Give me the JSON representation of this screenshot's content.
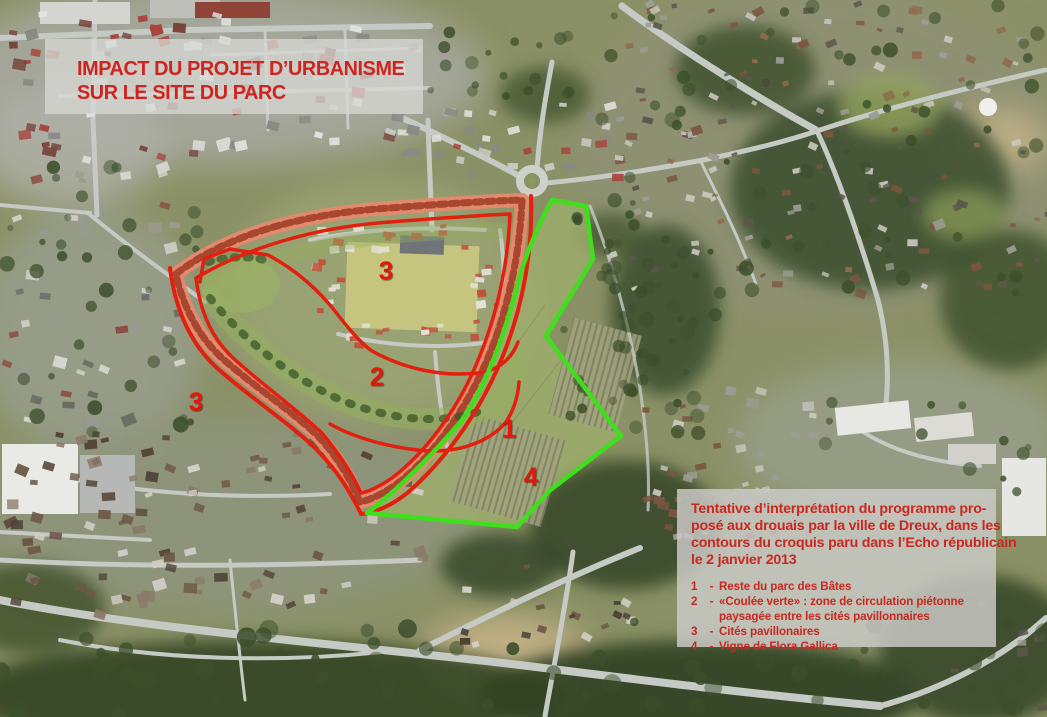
{
  "title_box": {
    "line1": "IMPACT DU PROJET D’URBANISME",
    "line2": "SUR LE SITE DU PARC"
  },
  "legend_box": {
    "paragraph_lines": [
      "Tentative d’interprétation du programme pro-",
      "posé aux drouais par la ville de Dreux, dans les",
      "contours du croquis paru dans l’Echo républicain",
      "le 2 janvier 2013"
    ],
    "items": [
      {
        "num": "1",
        "label": "Reste du parc des Bâtes"
      },
      {
        "num": "2",
        "label": "«Coulée verte» : zone de circulation piétonne paysagée entre les cités pavillonnaires"
      },
      {
        "num": "3",
        "label": "Cités pavillonaires"
      },
      {
        "num": "4",
        "label": "Vigne de Flora Gallica"
      }
    ]
  },
  "map_labels": [
    {
      "num": "3",
      "x": 386,
      "y": 271
    },
    {
      "num": "2",
      "x": 377,
      "y": 377
    },
    {
      "num": "3",
      "x": 196,
      "y": 402
    },
    {
      "num": "1",
      "x": 509,
      "y": 429
    },
    {
      "num": "4",
      "x": 531,
      "y": 477
    }
  ],
  "colors": {
    "overlay_red": "#e2200f",
    "overlay_green": "#3fdf1d",
    "overlay_salmon": "#e18a6d",
    "band_roofs": "#9e3a26",
    "text_red": "#c8281f",
    "panel_grey": "#cacac7"
  }
}
